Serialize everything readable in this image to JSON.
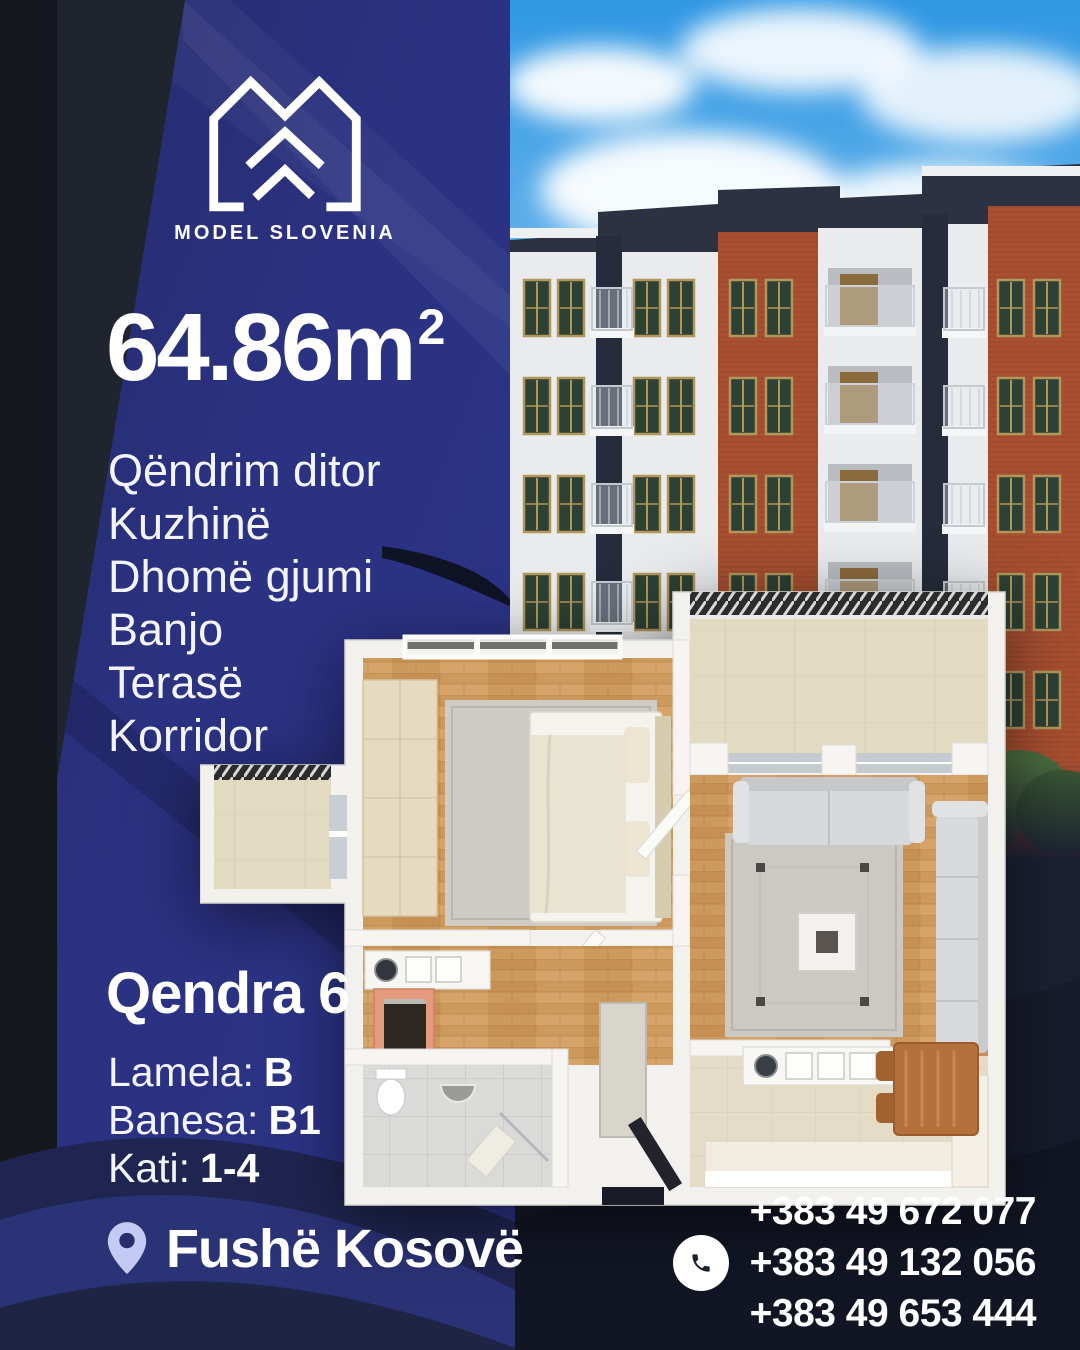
{
  "brand": {
    "name": "MODEL SLOVENIA"
  },
  "listing": {
    "area_value": "64.86m",
    "area_exponent": "2",
    "rooms": [
      "Qëndrim ditor",
      "Kuzhinë",
      "Dhomë gjumi",
      "Banjo",
      "Terasë",
      "Korridor"
    ],
    "project_name": "Qendra 6",
    "details": [
      {
        "label": "Lamela:",
        "value": "B"
      },
      {
        "label": "Banesa:",
        "value": "B1"
      },
      {
        "label": "Kati:",
        "value": "1-4"
      }
    ],
    "location": "Fushë Kosovë"
  },
  "contact": {
    "phones": [
      "+383 49 672 077",
      "+383 49 132 056",
      "+383 49 653 444"
    ]
  },
  "colors": {
    "background_blue": "#2a3180",
    "background_dark": "#1b2033",
    "pin_accent": "#c3cbf4",
    "text_white": "#ffffff",
    "brick": "#a85031",
    "window_green": "#2d4134"
  }
}
